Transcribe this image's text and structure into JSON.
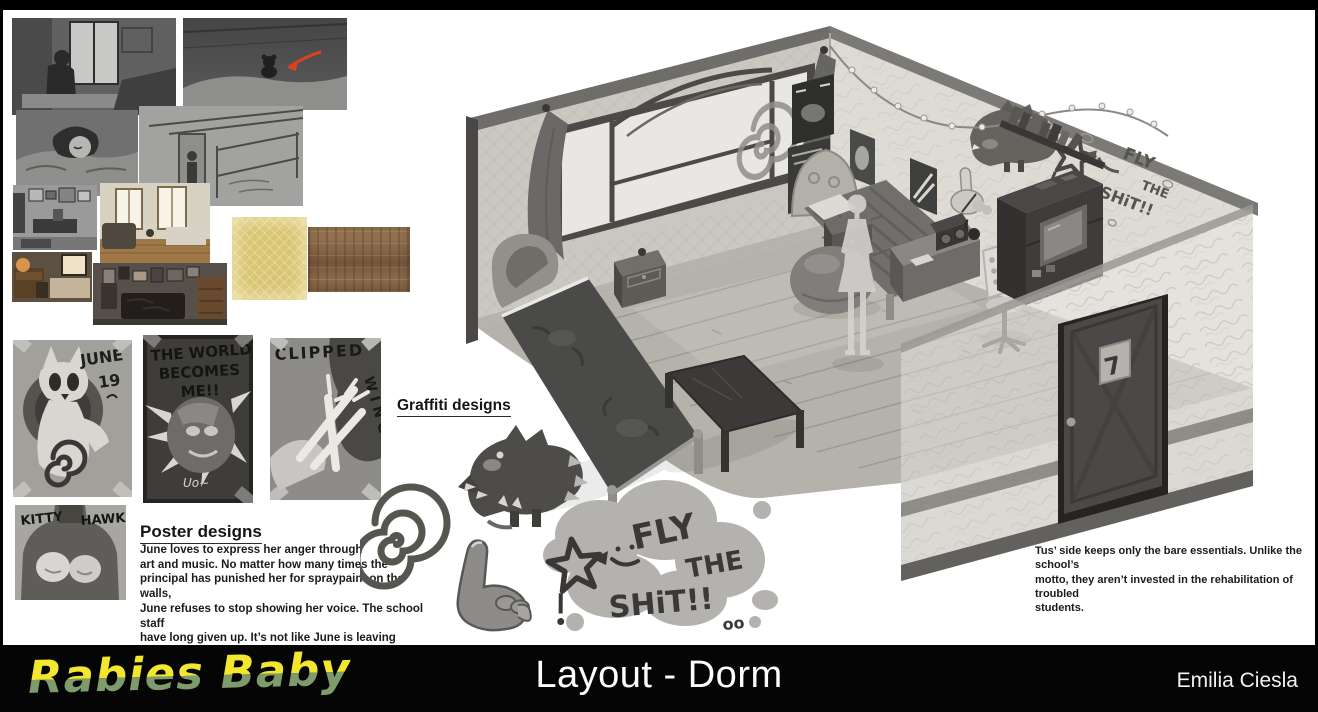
{
  "footer": {
    "logo": "Rabies Baby",
    "title": "Layout - Dorm",
    "artist": "Emilia Ciesla"
  },
  "poster_section": {
    "heading": "Poster designs",
    "body": "June loves to express her anger through\nart and music. No matter how many times the\nprincipal has punished her for spraypaint on the walls,\nJune refuses to stop showing her voice. The school staff\nhave long given up. It’s not like June is leaving anytime soon."
  },
  "graffiti_section": {
    "heading": "Graffiti designs"
  },
  "room_note": "Tus’ side keeps only the bare essentials. Unlike the school’s\nmotto, they aren’t invested in the rehabilitation of troubled\nstudents.",
  "posters": {
    "june19": {
      "line1": "JUNE",
      "line2": "19"
    },
    "world": {
      "line1": "THE WORLD",
      "line2": "BECOMES",
      "line3": "ME!!",
      "signature": "Uo~"
    },
    "clipped": {
      "line1": "CLIPPED",
      "line2": "WINGS"
    },
    "kitty_hawk": {
      "left": "KITTY",
      "right": "HAWK"
    }
  },
  "graffiti_cloud": {
    "line1": "FLY",
    "line2": "THE",
    "line3": "SHiT!!",
    "dots": "oo"
  },
  "room": {
    "door_number": "7",
    "wall_graffiti": {
      "line1": "FLY",
      "line2": "THE",
      "line3": "SHiT!!"
    }
  },
  "colors": {
    "logo_yellow": "#f3e62f",
    "logo_green": "#7e9b6d",
    "arrow_red": "#d8431f",
    "wallpaper_swatch": "#d9c572",
    "wood_swatch": "#8a6a4b",
    "footer_bg": "#050505"
  },
  "artwork_labels": {
    "storyboards": [
      "sketch-figure-by-window",
      "sketch-bed-with-plush",
      "sketch-sleeping-closeup",
      "sketch-room-wide"
    ],
    "reference_photos": [
      "photo-cluttered-room-bw",
      "photo-bright-room",
      "photo-dorm-desk-bed",
      "photo-dark-bedroom"
    ],
    "textures": [
      "wallpaper-texture",
      "wood-texture"
    ],
    "graffiti": [
      "spiral-doodle",
      "middle-finger-doodle",
      "rabid-dog-doodle",
      "fly-the-shit-graffiti"
    ]
  }
}
